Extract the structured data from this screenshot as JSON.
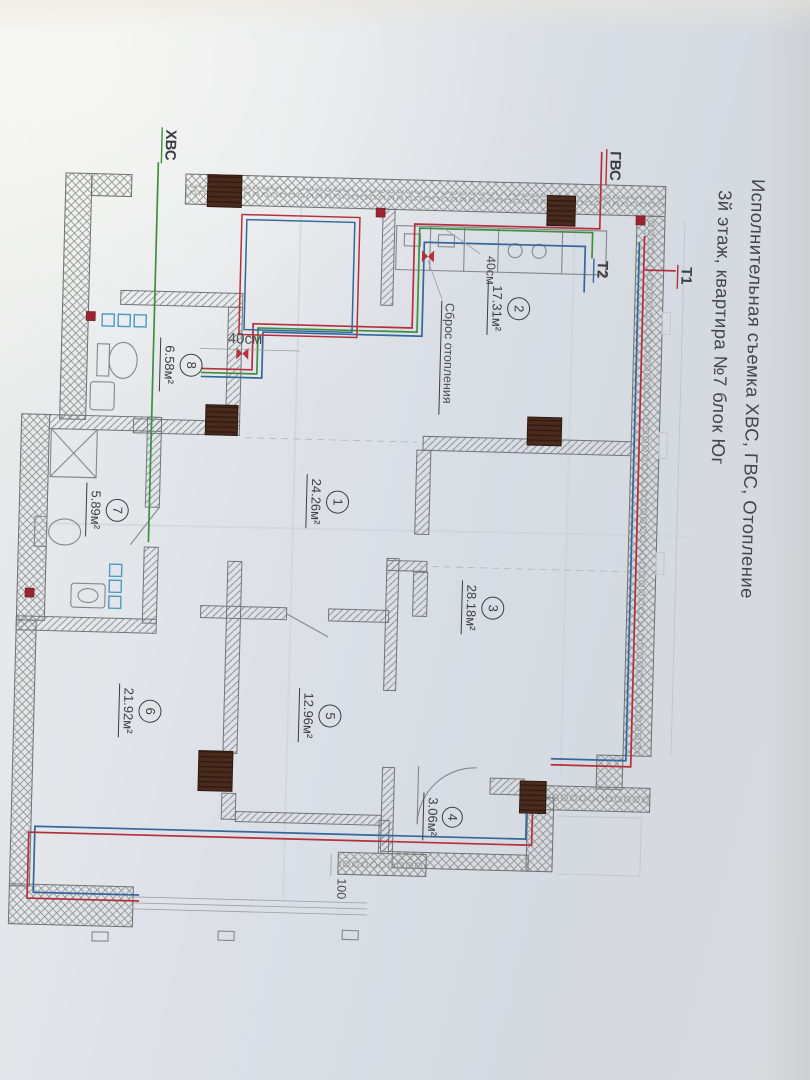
{
  "title": {
    "line1": "Исполнительная съемка ХВС, ГВС, Отопление",
    "line2": "3й этаж, квартира №7 блок Юг"
  },
  "pipe_labels": {
    "cold_water": "ХВС",
    "hot_water": "ГВС",
    "heating_supply": "Т1",
    "heating_return": "Т2"
  },
  "rooms": [
    {
      "number": "1",
      "area": "24.26м²"
    },
    {
      "number": "2",
      "area": "17.31м²"
    },
    {
      "number": "3",
      "area": "28.18м²"
    },
    {
      "number": "4",
      "area": "3.06м²"
    },
    {
      "number": "5",
      "area": "12.96м²"
    },
    {
      "number": "6",
      "area": "21.92м²"
    },
    {
      "number": "7",
      "area": "5.89м²"
    },
    {
      "number": "8",
      "area": "6.58м²"
    }
  ],
  "annotations": {
    "drain": "Сброс отопления",
    "dim40_a": "40см",
    "dim40_b": "40см",
    "dim100": "100"
  },
  "colors": {
    "cold_water_green": "#3f8f3f",
    "hot_water_red": "#b5303d",
    "heating_blue": "#35679c",
    "radiator_brown": "#4a2b1d",
    "wall_line": "#6e7270",
    "paper": "#dde1e7"
  }
}
